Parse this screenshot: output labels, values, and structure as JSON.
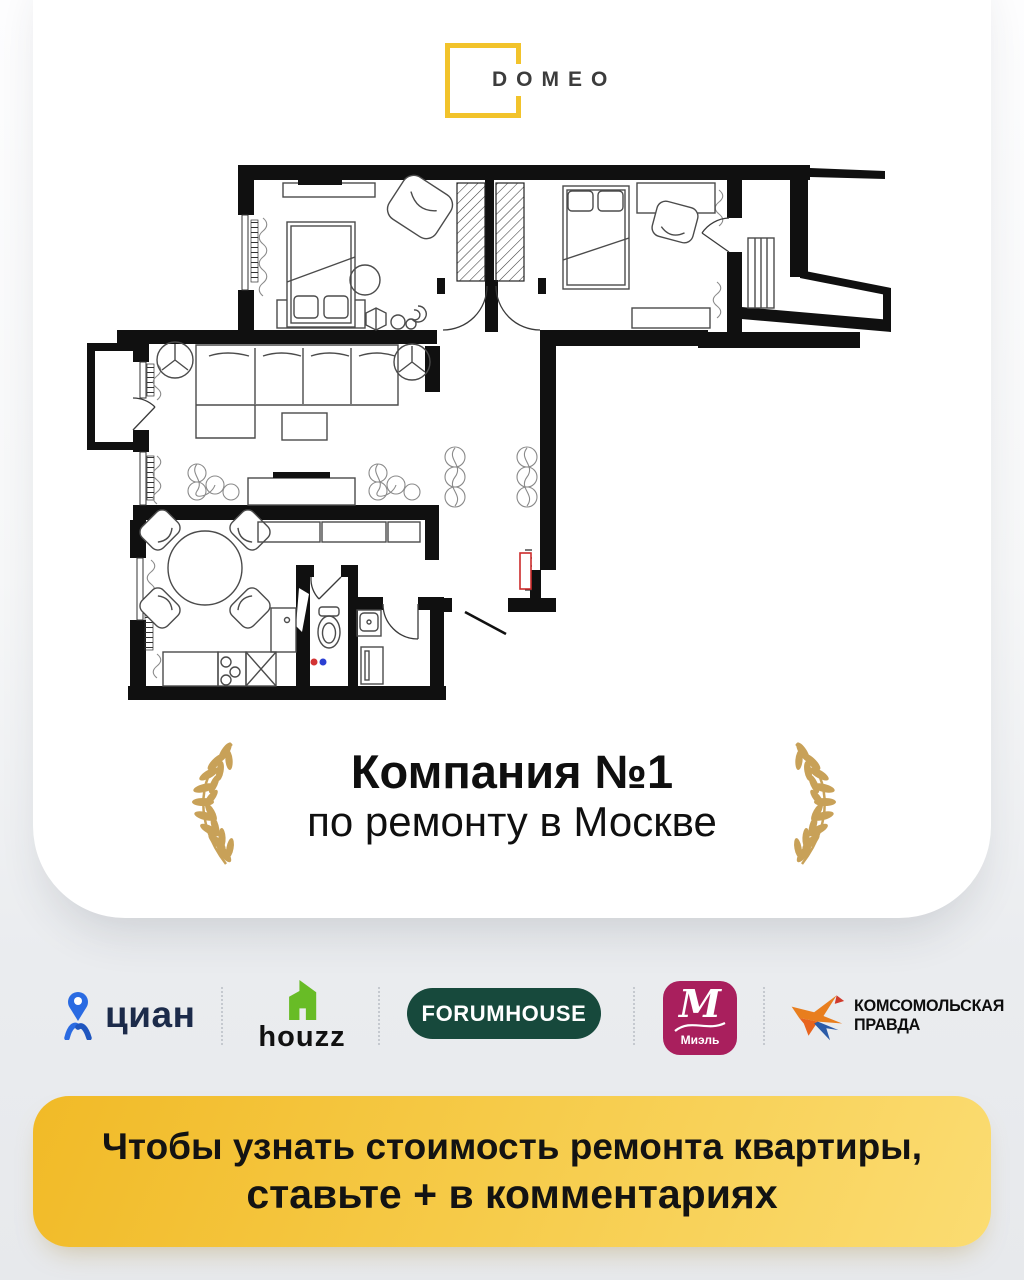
{
  "page": {
    "bg_top": "#fdfdfe",
    "bg_bottom": "#e7e9ed",
    "card_color": "#ffffff"
  },
  "brand": {
    "name": "DOMEO",
    "square_color": "#F2C32B",
    "text_color": "#3c3c3c"
  },
  "floorplan": {
    "wall_color": "#101010",
    "furniture_line_color": "#4b4b4b",
    "electrical_panel_color": "#cc2b2b",
    "hot_water_dot_color": "#d23333",
    "cold_water_dot_color": "#2b3fd2"
  },
  "award": {
    "line1": "Компания №1",
    "line2": "по ремонту в Москве",
    "laurel_color": "#C8A158",
    "text_color": "#0f0f0f"
  },
  "partners": [
    {
      "id": "cian",
      "label": "циан",
      "icon_color": "#2A6BE2",
      "text_color": "#1C2B4A"
    },
    {
      "id": "houzz",
      "label": "houzz",
      "icon_color": "#68BC26",
      "text_color": "#111111"
    },
    {
      "id": "forumhouse",
      "label": "FORUMHOUSE",
      "bg_color": "#17493C",
      "text_color": "#ffffff"
    },
    {
      "id": "miel",
      "monogram": "М",
      "label": "Миэль",
      "bg_color": "#A91F5D",
      "text_color": "#ffffff"
    },
    {
      "id": "komsomolskaya-pravda",
      "line1": "КОМСОМОЛЬСКАЯ",
      "line2": "ПРАВДА",
      "bird_orange": "#E87E1E",
      "bird_blue": "#2B5BA8",
      "text_color": "#0d0d0d"
    }
  ],
  "divider_color": "#c5c9cf",
  "banner": {
    "line1": "Чтобы узнать стоимость ремонта квартиры,",
    "line2": "ставьте + в комментариях",
    "bg_from": "#F1BA27",
    "bg_to": "#FBDC72",
    "text_color": "#131313"
  }
}
